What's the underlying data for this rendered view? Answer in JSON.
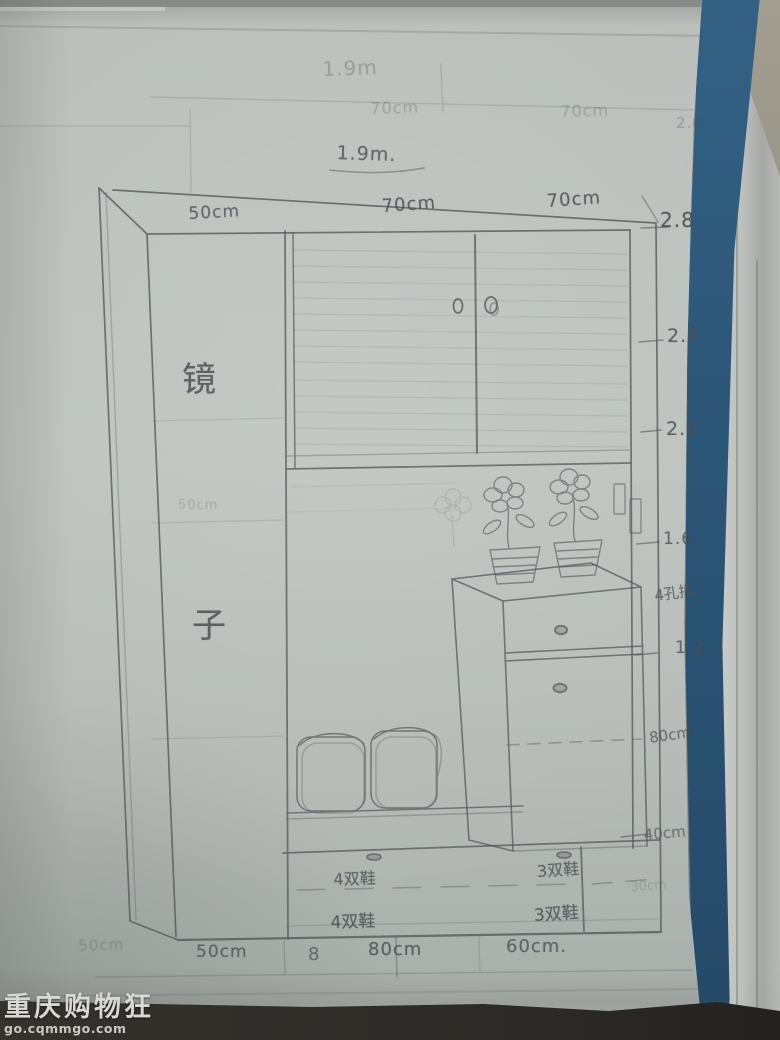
{
  "watermark": {
    "title": "重庆购物狂",
    "url": "go.cqmmgo.com"
  },
  "labels": {
    "faint_total_width": "1.9m",
    "faint_seg_left": "70cm",
    "faint_seg_right": "70cm",
    "faint_scale_top": "2.0",
    "total_width": "1.9m.",
    "seg_1": "50cm",
    "seg_2": "70cm",
    "seg_3": "70cm",
    "scale_28": "2.8",
    "scale_24": "2.4",
    "scale_20": "2.0",
    "scale_16": "1.6",
    "scale_12": "1.2",
    "socket_note": "4孔插",
    "dim_80": "80cm",
    "dim_40": "40cm",
    "faint_dim_30": "30cm",
    "mirror_top": "镜",
    "mirror_bottom": "子",
    "mirror_faint": "50cm",
    "shoe_row1_left": "4双鞋",
    "shoe_row1_right": "3双鞋",
    "shoe_row2_left": "4双鞋",
    "shoe_row2_right": "3双鞋",
    "bottom_faint": "50cm",
    "bottom_seg_1": "50cm",
    "bottom_mark_8": "8",
    "bottom_seg_2": "80cm",
    "bottom_seg_3": "60cm."
  },
  "colors": {
    "paper": "#b8bdba",
    "pencil": "#54585c",
    "folder_blue": "#2d5878",
    "table": "#948f84",
    "watermark_text": "#d8d8d4"
  }
}
